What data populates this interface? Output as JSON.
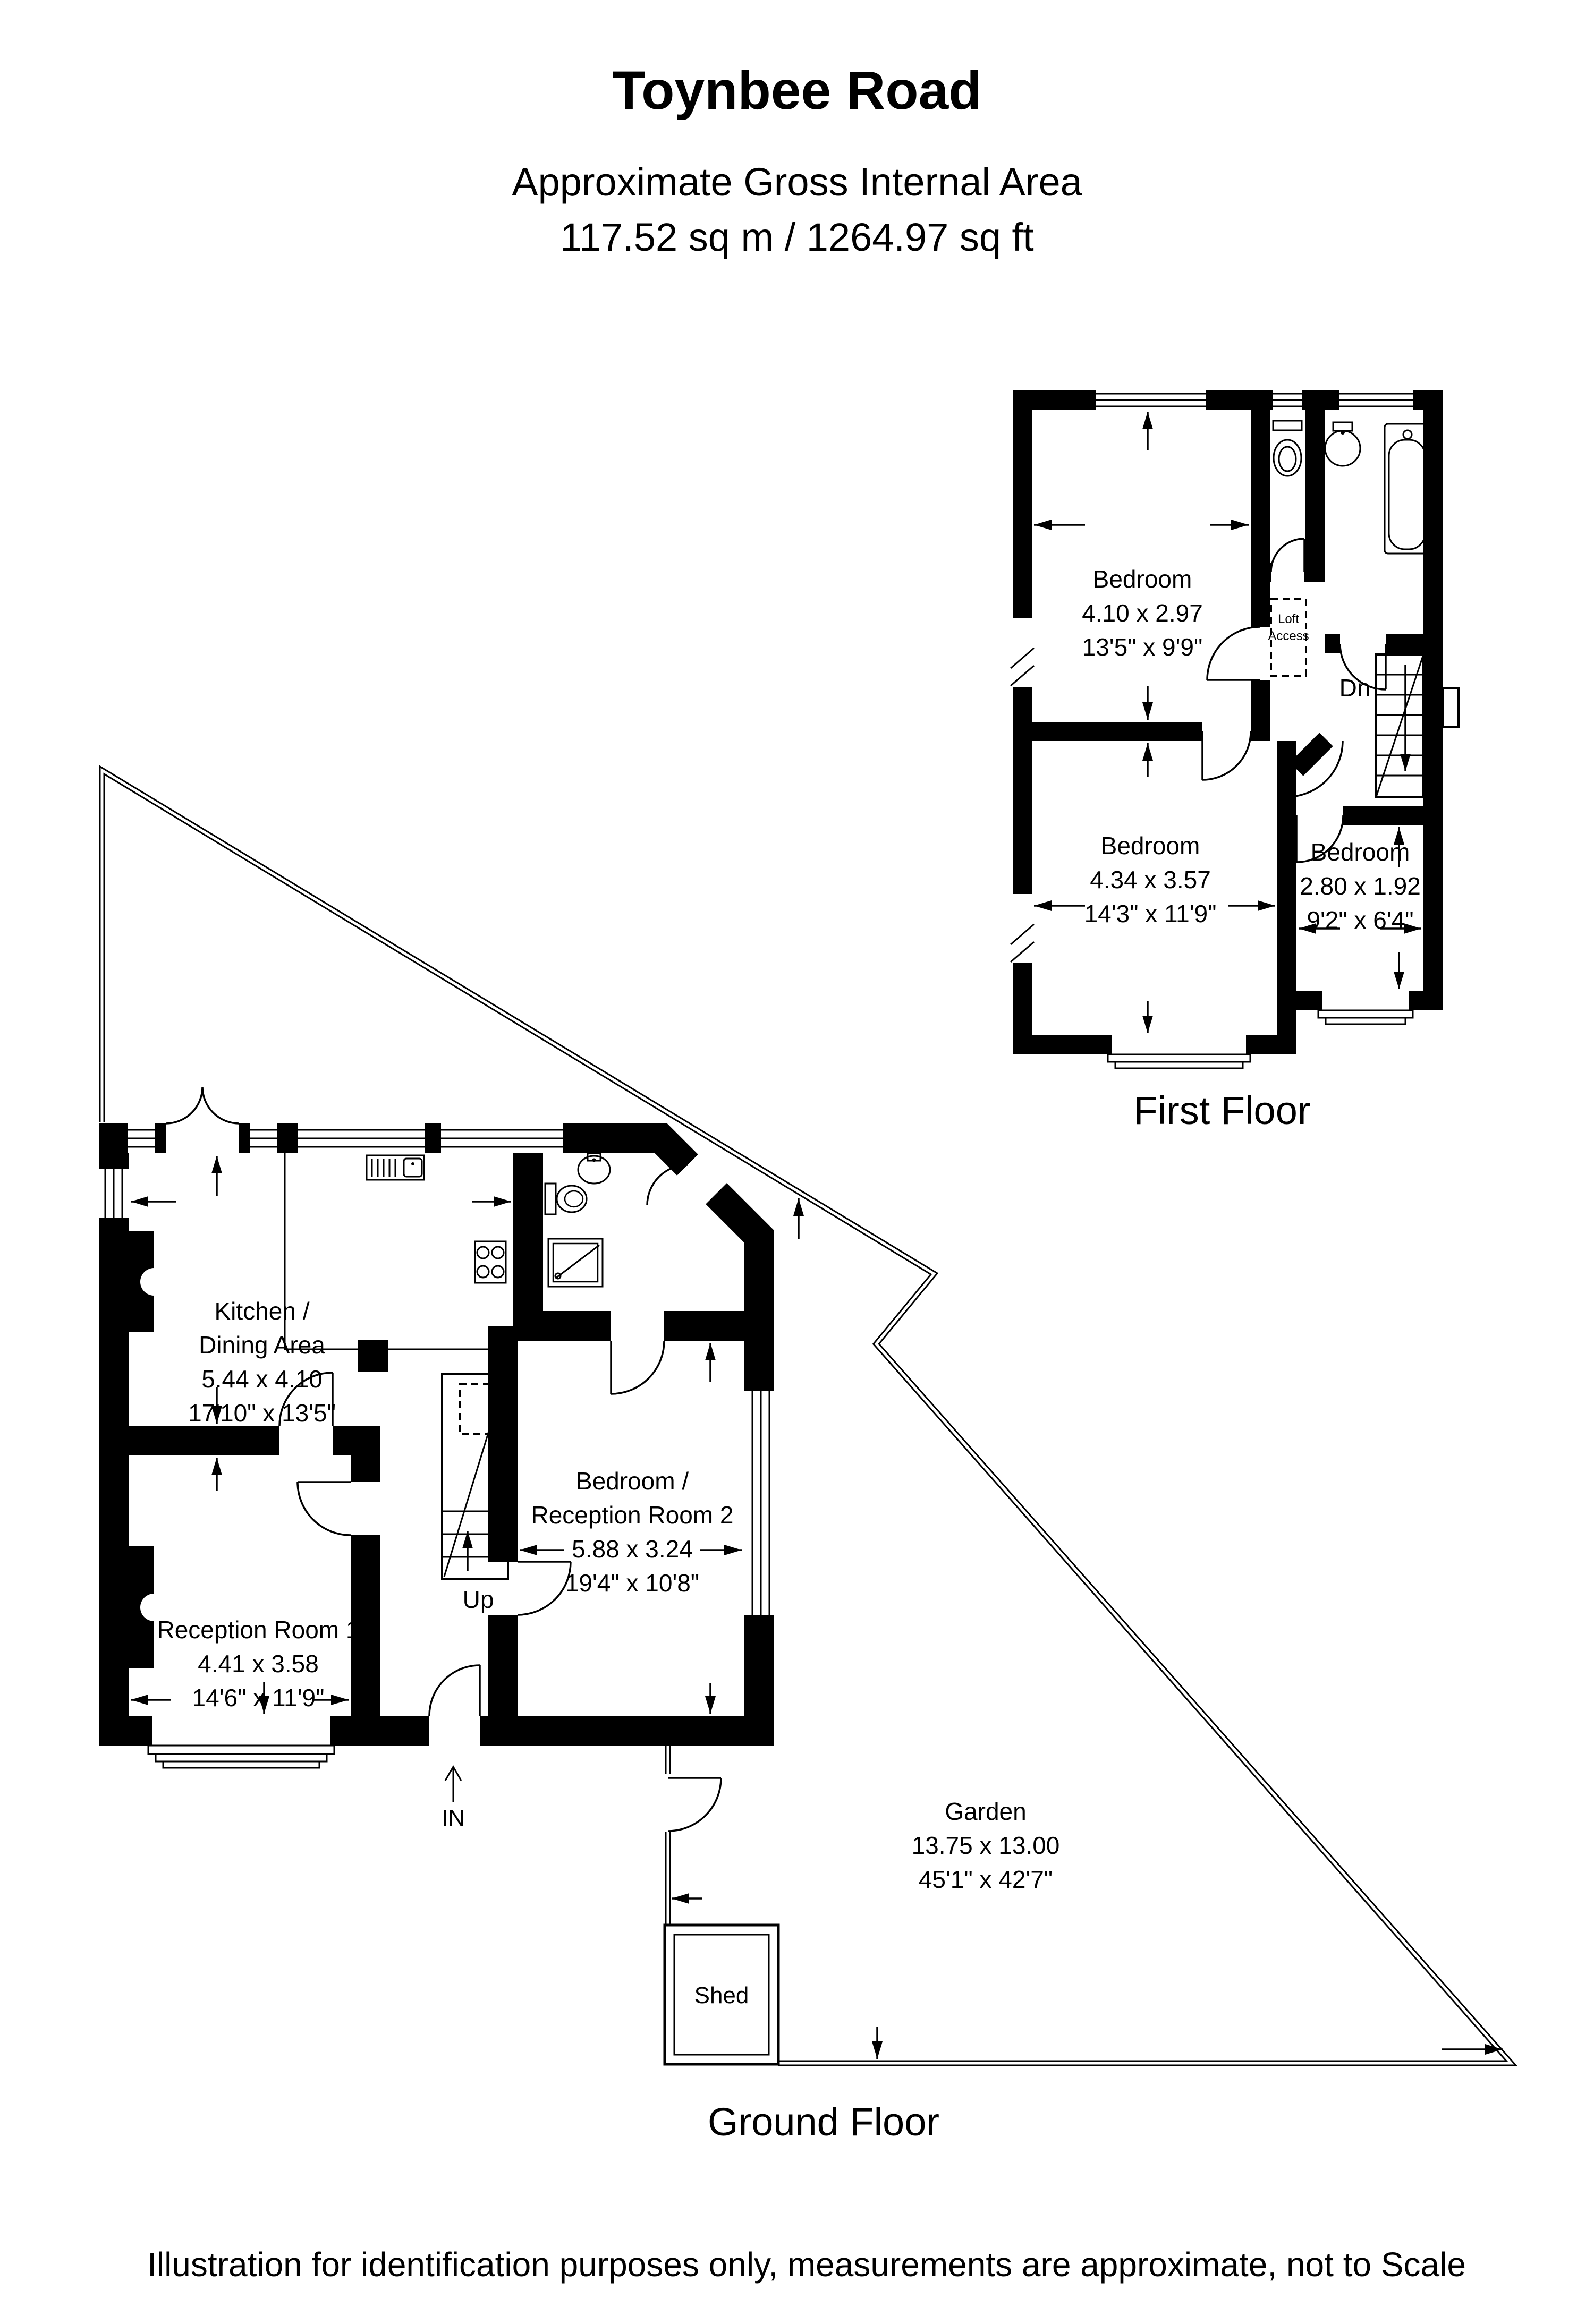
{
  "header": {
    "title": "Toynbee Road",
    "subtitle": "Approximate Gross Internal Area",
    "area": "117.52 sq m / 1264.97 sq ft"
  },
  "first_floor": {
    "label": "First Floor",
    "bedroom1": {
      "name": "Bedroom",
      "metric": "4.10 x 2.97",
      "imperial": "13'5\" x 9'9\""
    },
    "bedroom2": {
      "name": "Bedroom",
      "metric": "4.34 x 3.57",
      "imperial": "14'3\" x 11'9\""
    },
    "bedroom3": {
      "name": "Bedroom",
      "metric": "2.80 x 1.92",
      "imperial": "9'2\" x 6'4\""
    },
    "loft_access_line1": "Loft",
    "loft_access_line2": "Access",
    "stairs_down": "Dn"
  },
  "ground_floor": {
    "label": "Ground Floor",
    "kitchen": {
      "name_line1": "Kitchen /",
      "name_line2": "Dining Area",
      "metric": "5.44 x 4.10",
      "imperial": "17'10\" x 13'5\""
    },
    "reception1": {
      "name": "Reception Room 1",
      "metric": "4.41 x 3.58",
      "imperial": "14'6\" x 11'9\""
    },
    "bedroom_reception2": {
      "name_line1": "Bedroom /",
      "name_line2": "Reception Room 2",
      "metric": "5.88 x 3.24",
      "imperial": "19'4\" x 10'8\""
    },
    "garden": {
      "name": "Garden",
      "metric": "13.75 x 13.00",
      "imperial": "45'1\" x 42'7\""
    },
    "shed": "Shed",
    "stairs_up": "Up",
    "entrance": "IN"
  },
  "footer": {
    "disclaimer": "Illustration for identification purposes only, measurements are approximate, not to Scale"
  }
}
